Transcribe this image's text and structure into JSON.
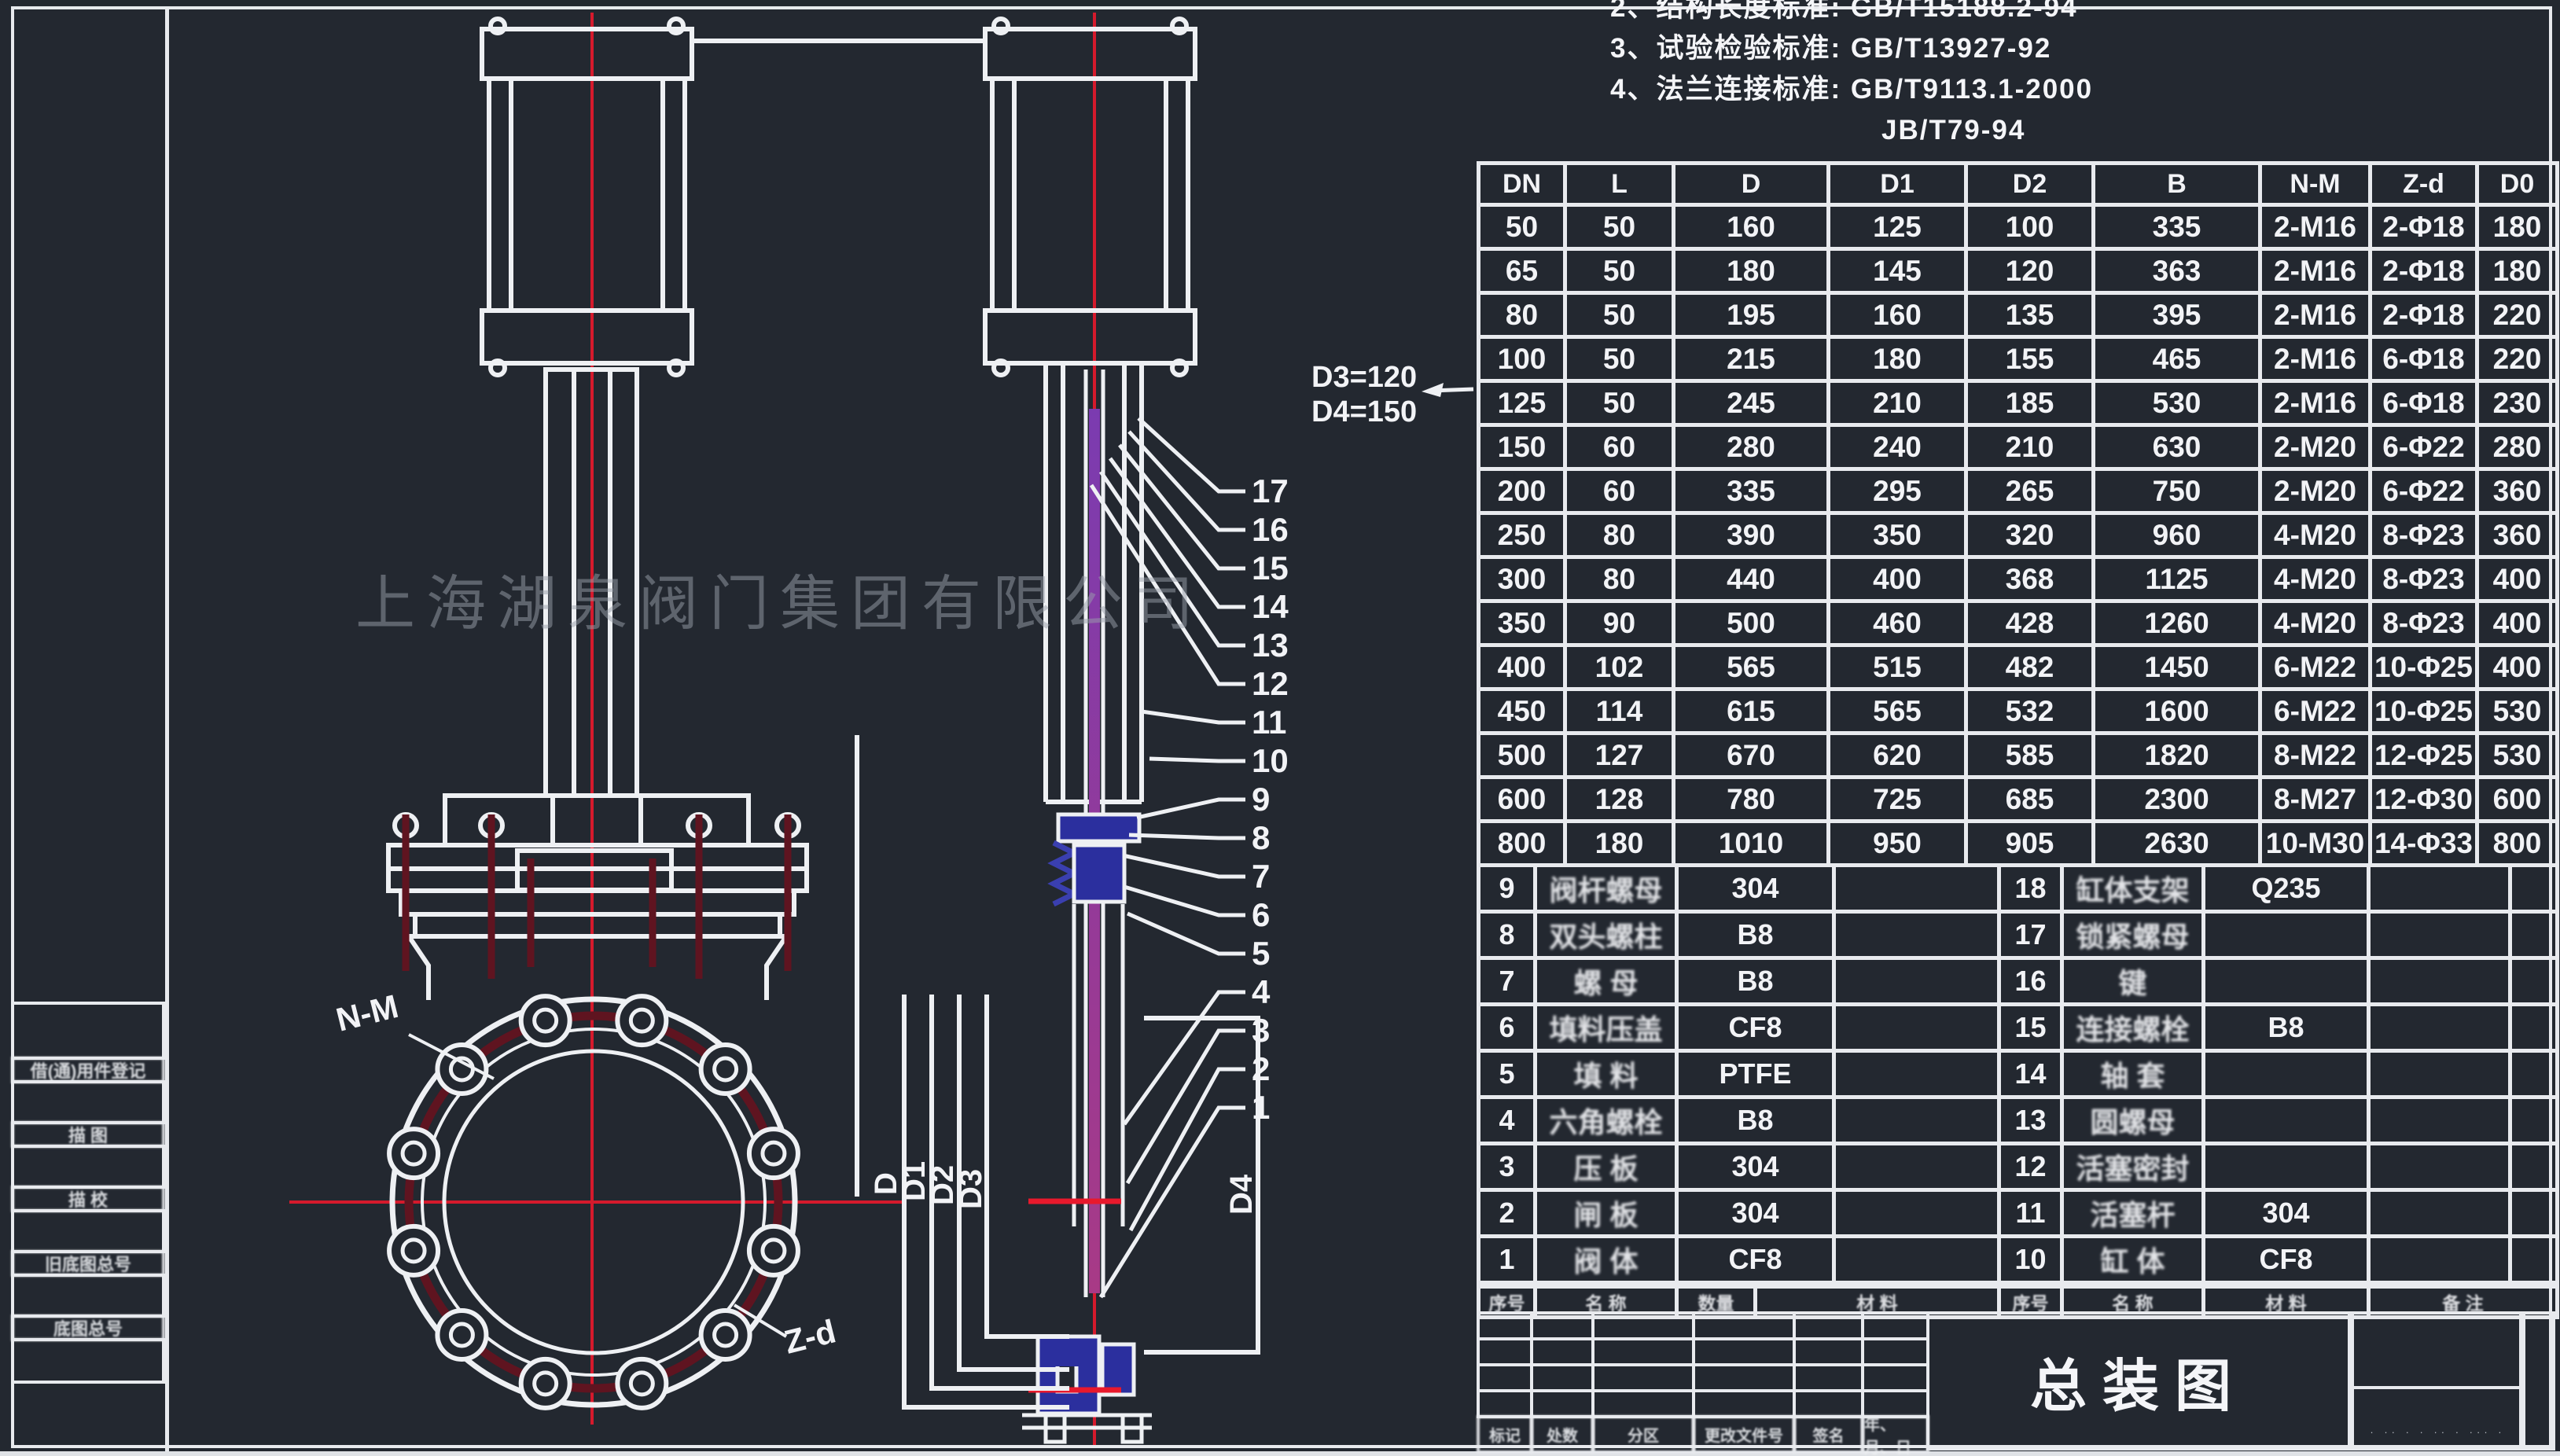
{
  "colors": {
    "background": "#232830",
    "line": "#e8eaee",
    "red": "#d51a2c",
    "dark_red": "#5f1420",
    "blue": "#2b2f9e",
    "purple": "#8a3aa0",
    "watermark_gray": "#9aa0ab"
  },
  "watermark": "上海湖泉阀门集团有限公司",
  "notes": {
    "lines": [
      "2、结构长度标准:  GB/T15188.2-94",
      "3、试验检验标准:  GB/T13927-92",
      "4、法兰连接标准:  GB/T9113.1-2000",
      "JB/T79-94"
    ]
  },
  "dimension_table": {
    "headers": [
      "DN",
      "L",
      "D",
      "D1",
      "D2",
      "B",
      "N-M",
      "Z-d",
      "D0"
    ],
    "rows": [
      [
        "50",
        "50",
        "160",
        "125",
        "100",
        "335",
        "2-M16",
        "2-Φ18",
        "180"
      ],
      [
        "65",
        "50",
        "180",
        "145",
        "120",
        "363",
        "2-M16",
        "2-Φ18",
        "180"
      ],
      [
        "80",
        "50",
        "195",
        "160",
        "135",
        "395",
        "2-M16",
        "2-Φ18",
        "220"
      ],
      [
        "100",
        "50",
        "215",
        "180",
        "155",
        "465",
        "2-M16",
        "6-Φ18",
        "220"
      ],
      [
        "125",
        "50",
        "245",
        "210",
        "185",
        "530",
        "2-M16",
        "6-Φ18",
        "230"
      ],
      [
        "150",
        "60",
        "280",
        "240",
        "210",
        "630",
        "2-M20",
        "6-Φ22",
        "280"
      ],
      [
        "200",
        "60",
        "335",
        "295",
        "265",
        "750",
        "2-M20",
        "6-Φ22",
        "360"
      ],
      [
        "250",
        "80",
        "390",
        "350",
        "320",
        "960",
        "4-M20",
        "8-Φ23",
        "360"
      ],
      [
        "300",
        "80",
        "440",
        "400",
        "368",
        "1125",
        "4-M20",
        "8-Φ23",
        "400"
      ],
      [
        "350",
        "90",
        "500",
        "460",
        "428",
        "1260",
        "4-M20",
        "8-Φ23",
        "400"
      ],
      [
        "400",
        "102",
        "565",
        "515",
        "482",
        "1450",
        "6-M22",
        "10-Φ25",
        "400"
      ],
      [
        "450",
        "114",
        "615",
        "565",
        "532",
        "1600",
        "6-M22",
        "10-Φ25",
        "530"
      ],
      [
        "500",
        "127",
        "670",
        "620",
        "585",
        "1820",
        "8-M22",
        "12-Φ25",
        "530"
      ],
      [
        "600",
        "128",
        "780",
        "725",
        "685",
        "2300",
        "8-M27",
        "12-Φ30",
        "600"
      ],
      [
        "800",
        "180",
        "1010",
        "950",
        "905",
        "2630",
        "10-M30",
        "14-Φ33",
        "800"
      ]
    ]
  },
  "bom": {
    "left_rows": [
      {
        "no": "9",
        "name": "阀杆螺母",
        "material": "304"
      },
      {
        "no": "8",
        "name": "双头螺柱",
        "material": "B8"
      },
      {
        "no": "7",
        "name": "螺  母",
        "material": "B8"
      },
      {
        "no": "6",
        "name": "填料压盖",
        "material": "CF8"
      },
      {
        "no": "5",
        "name": "填  料",
        "material": "PTFE"
      },
      {
        "no": "4",
        "name": "六角螺栓",
        "material": "B8"
      },
      {
        "no": "3",
        "name": "压  板",
        "material": "304"
      },
      {
        "no": "2",
        "name": "闸  板",
        "material": "304"
      },
      {
        "no": "1",
        "name": "阀  体",
        "material": "CF8"
      }
    ],
    "right_rows": [
      {
        "no": "18",
        "name": "缸体支架",
        "material": "Q235"
      },
      {
        "no": "17",
        "name": "锁紧螺母",
        "material": ""
      },
      {
        "no": "16",
        "name": "键",
        "material": ""
      },
      {
        "no": "15",
        "name": "连接螺栓",
        "material": "B8"
      },
      {
        "no": "14",
        "name": "轴  套",
        "material": ""
      },
      {
        "no": "13",
        "name": "圆螺母",
        "material": ""
      },
      {
        "no": "12",
        "name": "活塞密封",
        "material": ""
      },
      {
        "no": "11",
        "name": "活塞杆",
        "material": "304"
      },
      {
        "no": "10",
        "name": "缸  体",
        "material": "CF8"
      }
    ],
    "footer": [
      "序号",
      "名  称",
      "数量",
      "材  料",
      "序号",
      "名  称",
      "材  料",
      "备  注"
    ]
  },
  "title_block": {
    "drawing_title": "总装图",
    "revision_row": [
      "标记",
      "处数",
      "分区",
      "更改文件号",
      "签名",
      "年、月、日"
    ],
    "micro_text": "· ·· · · ·· · ··· ·"
  },
  "margin_labels": [
    "借(通)用件登记",
    "描 图",
    "描 校",
    "旧底图总号",
    "底图总号"
  ],
  "drawing_labels": {
    "nm": "N-M",
    "zd": "Z-d",
    "d": "D",
    "d1": "D1",
    "d2": "D2",
    "d3": "D3",
    "d4": "D4",
    "d3_note": "D3=120",
    "d4_note": "D4=150"
  },
  "callouts": {
    "numbers": [
      "17",
      "16",
      "15",
      "14",
      "13",
      "12",
      "11",
      "10",
      "9",
      "8",
      "7",
      "6",
      "5",
      "4",
      "3",
      "2",
      "1"
    ]
  }
}
